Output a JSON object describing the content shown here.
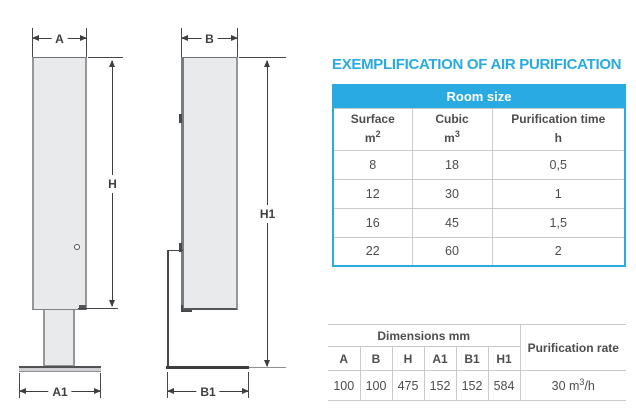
{
  "colors": {
    "accent": "#29abe2",
    "text": "#4d4d4f",
    "grid_line": "#c9cacc",
    "drawing_fill": "#e9eaeb",
    "drawing_outline": "#96979a"
  },
  "title": "EXEMPLIFICATION OF AIR PURIFICATION",
  "diagram": {
    "front": {
      "width_label": "A",
      "height_label": "H",
      "base_width_label": "A1"
    },
    "side": {
      "depth_label": "B",
      "height_label": "H1",
      "base_depth_label": "B1"
    }
  },
  "room_table": {
    "header": "Room size",
    "columns": [
      {
        "name": "Surface",
        "unit": "m",
        "unit_sup": "2"
      },
      {
        "name": "Cubic",
        "unit": "m",
        "unit_sup": "3"
      },
      {
        "name": "Purification time",
        "unit": "h",
        "unit_sup": ""
      }
    ],
    "rows": [
      [
        "8",
        "18",
        "0,5"
      ],
      [
        "12",
        "30",
        "1"
      ],
      [
        "16",
        "45",
        "1,5"
      ],
      [
        "22",
        "60",
        "2"
      ]
    ]
  },
  "dims_table": {
    "header": "Dimensions mm",
    "columns": [
      "A",
      "B",
      "H",
      "A1",
      "B1",
      "H1"
    ],
    "values": [
      "100",
      "100",
      "475",
      "152",
      "152",
      "584"
    ],
    "rate_header": "Purification rate",
    "rate_value": "30 m",
    "rate_value_sup": "3",
    "rate_value_suffix": "/h"
  }
}
